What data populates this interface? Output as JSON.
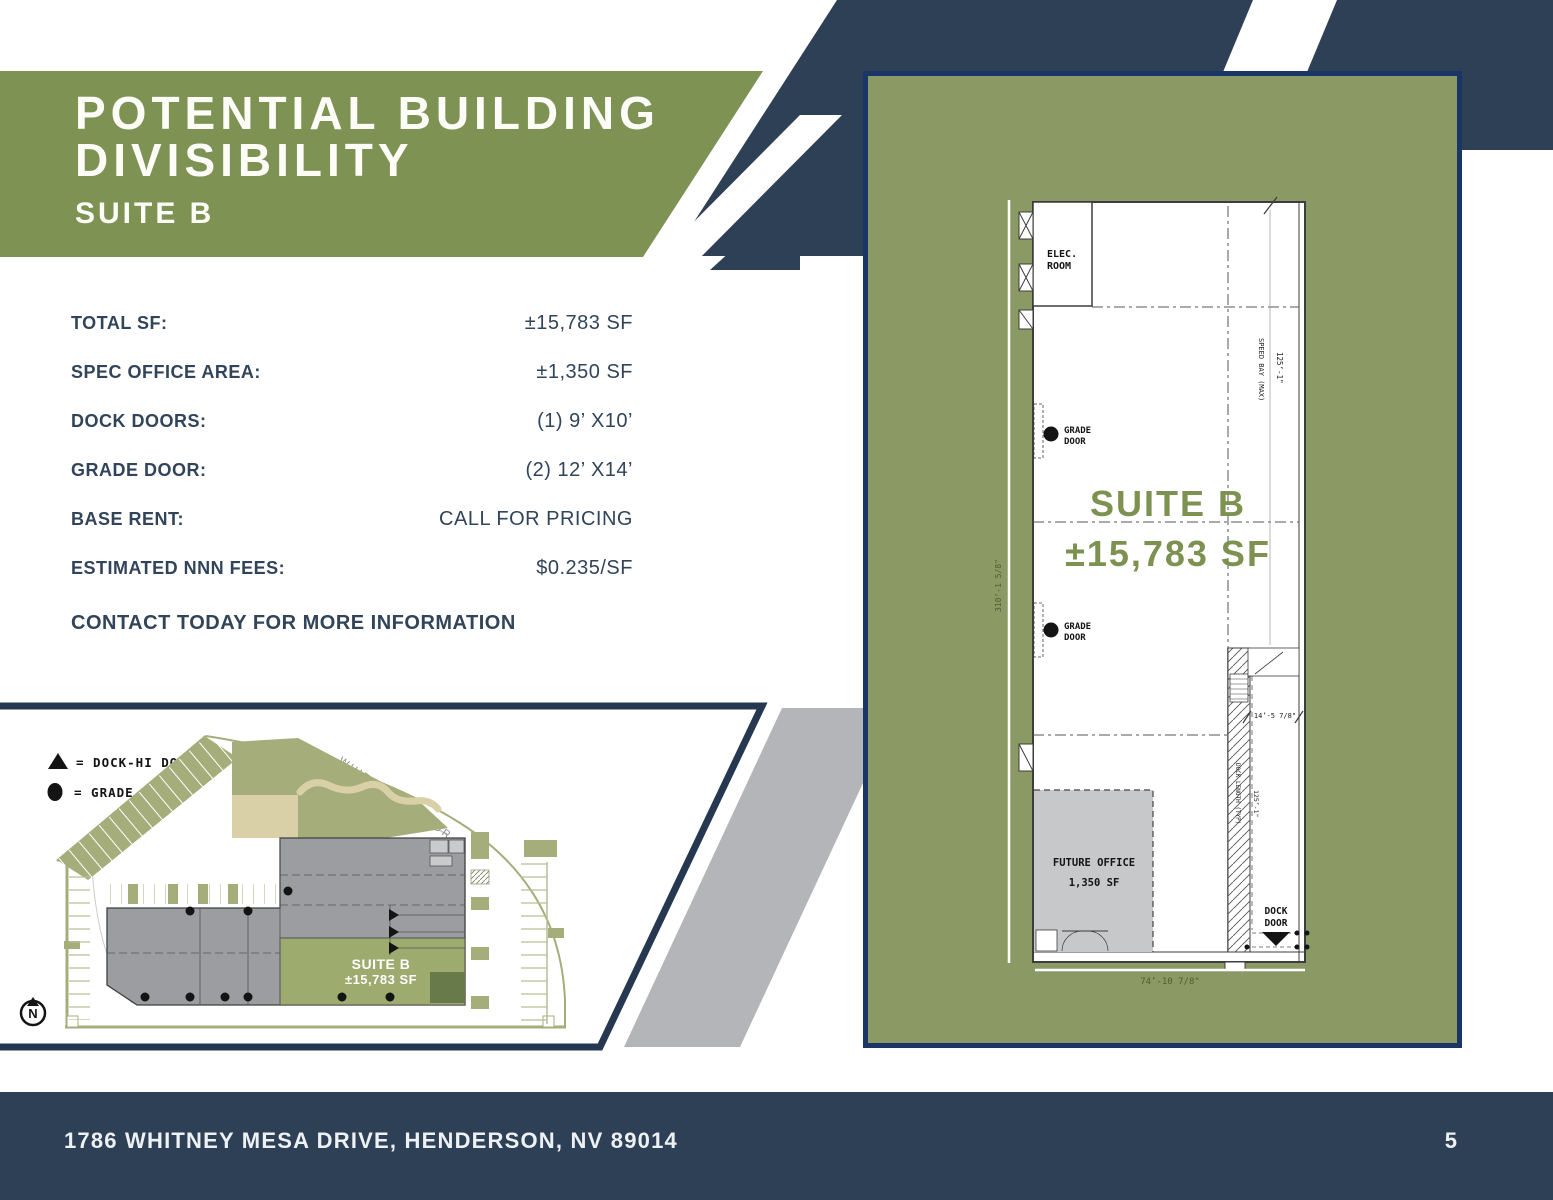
{
  "header": {
    "title_line1": "POTENTIAL BUILDING",
    "title_line2": "DIVISIBILITY",
    "subtitle": "SUITE B"
  },
  "specs": {
    "rows": [
      {
        "label": "TOTAL SF:",
        "value": "±15,783 SF"
      },
      {
        "label": "SPEC OFFICE AREA:",
        "value": "±1,350 SF"
      },
      {
        "label": "DOCK DOORS:",
        "value": "(1) 9’ X10’"
      },
      {
        "label": "GRADE DOOR:",
        "value": "(2) 12’ X14’"
      },
      {
        "label": "BASE RENT:",
        "value": "CALL FOR PRICING"
      },
      {
        "label": "ESTIMATED NNN FEES:",
        "value": "$0.235/SF"
      }
    ],
    "contact": "CONTACT TODAY FOR MORE INFORMATION"
  },
  "site_plan": {
    "legend_dock": "= DOCK-HI DOOR",
    "legend_grade": "= GRADE DOOR",
    "road_label": "WHITNEY MESA DR",
    "suite_label": "SUITE B",
    "suite_sf": "±15,783 SF",
    "north_letter": "N"
  },
  "floor_plan": {
    "elec_line1": "ELEC.",
    "elec_line2": "ROOM",
    "grade_label_line1": "GRADE",
    "grade_label_line2": "DOOR",
    "suite_title": "SUITE B",
    "suite_sf": "±15,783 SF",
    "future_line1": "FUTURE OFFICE",
    "future_line2": "1,350 SF",
    "dock_label_line1": "DOCK",
    "dock_label_line2": "DOOR",
    "dims": {
      "speed_bay": "SPEED BAY (MAX)",
      "bay_depth": "125’-1\"",
      "overall_left": "310’-1 5/8\"",
      "stair_width": "14’-5 7/8\"",
      "dock_length": "DOCK LENGTH (TYP)",
      "dock_length_dim": "125’-1\"",
      "overall_bottom": "74’-10 7/8\""
    }
  },
  "footer": {
    "address": "1786 WHITNEY MESA DRIVE, HENDERSON, NV 89014",
    "page_number": "5"
  },
  "colors": {
    "navy": "#2e4056",
    "navy-deep": "#253850",
    "panel-border": "#1a3667",
    "green-banner": "#7e9254",
    "green-panel": "#8b9a64",
    "green-text": "#7d9150",
    "olive": "#a5ae7a",
    "suite-green": "#9dab6f",
    "dark-green": "#68794a",
    "gray-band": "#b3b5b8",
    "bldg-gray": "#9b9da0",
    "office-gray": "#c7c8ca",
    "tan": "#d9d0a8",
    "ink": "#31445a"
  }
}
